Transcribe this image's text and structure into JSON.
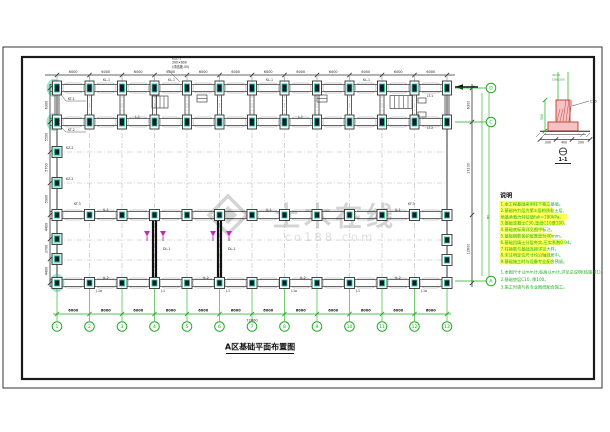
{
  "colors": {
    "line": "#2a2a2a",
    "thin": "#555555",
    "grid": "#b7b7b7",
    "capsule": "#9a9a9a",
    "green": "#1cab1c",
    "teal": "#2cc494",
    "tealFill": "#bdeedd",
    "dark": "#0c1b33",
    "magenta": "#cc22cc",
    "red": "#c0392b",
    "redFill": "#f5c3c3",
    "yellow": "#ffff55",
    "noteGreen": "#1fae1f",
    "watermark": "#d4d4d4",
    "black": "#111111"
  },
  "title": {
    "text": "A区基础平面布置图"
  },
  "watermark": {
    "main": "土木在线",
    "sub": "co188.com"
  },
  "notes": {
    "header": "说明",
    "yellow": [
      "1.本工程基础采用柱下独立基础。",
      "2.基础持力层为第②层粉质粘土层,",
      "   地基承载力特征值fak=180kPa。",
      "3.基础混凝土C30,垫层C10厚100。",
      "4.基础底标高详见图中标注。",
      "5.基础钢筋保护层厚度为40mm。",
      "6.基础回填土分层夯实,压实系数0.94。",
      "7.柱插筋与基础连接详见大样。",
      "8.未注明定位尺寸均沿轴线居中。",
      "9.基础施工时与设备专业配合预留。"
    ],
    "green": [
      "1.本图尺寸以mm计,标高以m计,详见总说明(结施-01)。",
      "2.基础垫层C10, 厚100。",
      "3.施工时请与各专业图纸配合施工。"
    ]
  },
  "plan": {
    "x_axes": [
      57,
      89.5,
      122,
      154.5,
      187,
      219.5,
      252,
      284.5,
      317,
      349.5,
      382,
      414.5,
      447
    ],
    "axis_numbers": [
      "1",
      "2",
      "3",
      "4",
      "5",
      "6",
      "7",
      "8",
      "9",
      "10",
      "11",
      "12",
      "13"
    ],
    "rows": [
      88,
      122,
      215,
      283
    ],
    "left_extra_rows": [
      152,
      183,
      239,
      259
    ],
    "right_extra_rows": [
      240,
      260
    ],
    "walls_x": [
      154.5,
      219.5
    ],
    "section_marker_x": [
      147,
      163,
      213,
      229
    ],
    "right_circles": [
      {
        "y": 88,
        "label": "D"
      },
      {
        "y": 122,
        "label": "C"
      },
      {
        "y": 281,
        "label": "A"
      }
    ],
    "right_mid_label": {
      "y": 219,
      "label": "B"
    },
    "span_dim": "6000",
    "total_dim": "72000",
    "height_dims": [
      "6300",
      "17200",
      "12600"
    ],
    "left_dims": [
      "6300",
      "5500",
      "5700",
      "5900",
      "4400",
      "3700",
      "4400"
    ],
    "top_label": [
      "KZL-1",
      "300×600",
      "(详结施-05)"
    ],
    "labels": [
      {
        "t": "KT-1",
        "x": 68,
        "y": 100
      },
      {
        "t": "KT-2",
        "x": 68,
        "y": 131
      },
      {
        "t": "LT-1",
        "x": 427,
        "y": 97
      },
      {
        "t": "LT-2",
        "x": 427,
        "y": 129
      },
      {
        "t": "KZ-2",
        "x": 66,
        "y": 149
      },
      {
        "t": "KZ-2",
        "x": 66,
        "y": 180
      },
      {
        "t": "KT-3",
        "x": 74,
        "y": 205
      },
      {
        "t": "KT-3",
        "x": 408,
        "y": 205
      },
      {
        "t": "KL-1",
        "x": 103,
        "y": 81
      },
      {
        "t": "KL-1",
        "x": 168,
        "y": 81
      },
      {
        "t": "KL-1",
        "x": 266,
        "y": 81
      },
      {
        "t": "KL-1",
        "x": 363,
        "y": 81
      },
      {
        "t": "L-1",
        "x": 135,
        "y": 118
      },
      {
        "t": "L-1",
        "x": 298,
        "y": 118
      },
      {
        "t": "JL-1",
        "x": 103,
        "y": 211
      },
      {
        "t": "JL-1",
        "x": 266,
        "y": 211
      },
      {
        "t": "JL-1",
        "x": 395,
        "y": 211
      },
      {
        "t": "JL-2",
        "x": 103,
        "y": 279
      },
      {
        "t": "JL-2",
        "x": 203,
        "y": 279
      },
      {
        "t": "JL-2",
        "x": 300,
        "y": 279
      },
      {
        "t": "JL-2",
        "x": 395,
        "y": 279
      },
      {
        "t": "J-1a",
        "x": 96,
        "y": 292
      },
      {
        "t": "J-1",
        "x": 161,
        "y": 292
      },
      {
        "t": "J-1",
        "x": 226,
        "y": 292
      },
      {
        "t": "J-1a",
        "x": 291,
        "y": 292
      },
      {
        "t": "J-1",
        "x": 356,
        "y": 292
      },
      {
        "t": "J-1a",
        "x": 421,
        "y": 292
      },
      {
        "t": "DL-1",
        "x": 163,
        "y": 250
      },
      {
        "t": "DL-1",
        "x": 228,
        "y": 250
      }
    ]
  },
  "detail": {
    "top_texts": [
      "4C14",
      "C8@200"
    ],
    "left_dim": "500",
    "bottom_dims": [
      "200",
      "400",
      "200"
    ],
    "leader": "C10",
    "bubble": "1-1"
  }
}
